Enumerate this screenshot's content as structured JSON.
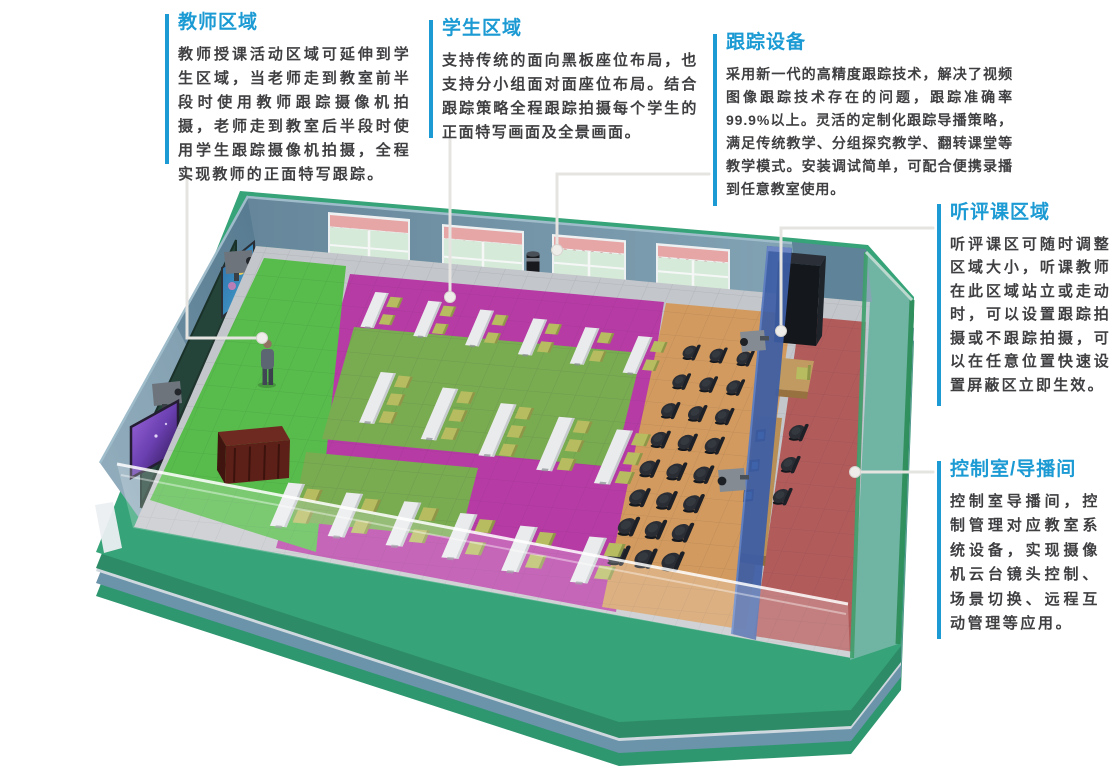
{
  "page": {
    "width": 1116,
    "height": 766,
    "background": "#ffffff"
  },
  "accent_color": "#1b9ad3",
  "text_color": "#3f3f42",
  "annotations": {
    "teacher": {
      "title": "教师区域",
      "body": "教师授课活动区域可延伸到学生区域，当老师走到教室前半段时使用教师跟踪摄像机拍摄，老师走到教室后半段时使用学生跟踪摄像机拍摄，全程实现教师的正面特写跟踪。"
    },
    "student": {
      "title": "学生区域",
      "body": "支持传统的面向黑板座位布局，也支持分小组面对面座位布局。结合跟踪策略全程跟踪拍摄每个学生的正面特写画面及全景画面。"
    },
    "tracking": {
      "title": "跟踪设备",
      "body": "采用新一代的高精度跟踪技术，解决了视频图像跟踪技术存在的问题，跟踪准确率99.9%以上。灵活的定制化跟踪导播策略，满足传统教学、分组探究教学、翻转课堂等教学模式。安装调试简单，可配合便携录播到任意教室使用。"
    },
    "observation": {
      "title": "听评课区域",
      "body": "听评课区可随时调整区域大小，听课教师在此区域站立或走动时，可以设置跟踪拍摄或不跟踪拍摄，可以在任意位置快速设置屏蔽区立即生效。"
    },
    "control": {
      "title": "控制室/导播间",
      "body": "控制室导播间，控制管理对应教室系统设备，实现摄像机云台镜头控制、场景切换、远程互动管理等应用。"
    }
  },
  "scene": {
    "colors": {
      "platform": "#36a378",
      "platform_front": "#2d8c67",
      "platform_light_edge": "#cfd8de",
      "platform_rim": "#6b94aa",
      "platform_base": "#2f9770",
      "floor": "#c3c6ca",
      "wall_back": "#66869b",
      "wall_back_light": "#7fa0b2",
      "wall_left": "#5b7e94",
      "wall_control": "#5f8398",
      "teacher_zone": "#57bc4b",
      "student_zone": "#b73ba5",
      "carpet": "#79ab51",
      "observation_zone": "#d29a5e",
      "control_zone": "#b25b5b",
      "partition": "#3d5ea6",
      "glass_frame_green": "#2f8f5c",
      "blackboard": "#24443a",
      "desk_top": "#e9ebec",
      "chair_olive": "#b6bc5f",
      "chair_black": "#26282e",
      "podium": "#5c2018",
      "wood": "#b98f58",
      "leader_line": "#e6e4e1",
      "leader_dot": "#efede9"
    },
    "desks2": [
      [
        375,
        310
      ],
      [
        428,
        319
      ],
      [
        480,
        328
      ],
      [
        533,
        337
      ],
      [
        585,
        346
      ],
      [
        638,
        355
      ],
      [
        288,
        505
      ],
      [
        346,
        515
      ],
      [
        404,
        524
      ],
      [
        460,
        536
      ],
      [
        520,
        549
      ],
      [
        589,
        560
      ]
    ],
    "desks3": [
      [
        378,
        398
      ],
      [
        440,
        414
      ],
      [
        498,
        430
      ],
      [
        556,
        444
      ],
      [
        614,
        457
      ]
    ],
    "black_chairs": [
      [
        690,
        352
      ],
      [
        717,
        355
      ],
      [
        744,
        358
      ],
      [
        680,
        381
      ],
      [
        707,
        384
      ],
      [
        734,
        387
      ],
      [
        669,
        410
      ],
      [
        696,
        413
      ],
      [
        723,
        416
      ],
      [
        659,
        439
      ],
      [
        686,
        442
      ],
      [
        713,
        445
      ],
      [
        648,
        468
      ],
      [
        675,
        471
      ],
      [
        702,
        474
      ],
      [
        638,
        497
      ],
      [
        665,
        500
      ],
      [
        692,
        503
      ],
      [
        627,
        526
      ],
      [
        654,
        529
      ],
      [
        681,
        532
      ],
      [
        617,
        555
      ],
      [
        644,
        558
      ],
      [
        671,
        561
      ]
    ],
    "control_chairs": [
      [
        797,
        432
      ],
      [
        789,
        464
      ],
      [
        781,
        496
      ]
    ]
  }
}
